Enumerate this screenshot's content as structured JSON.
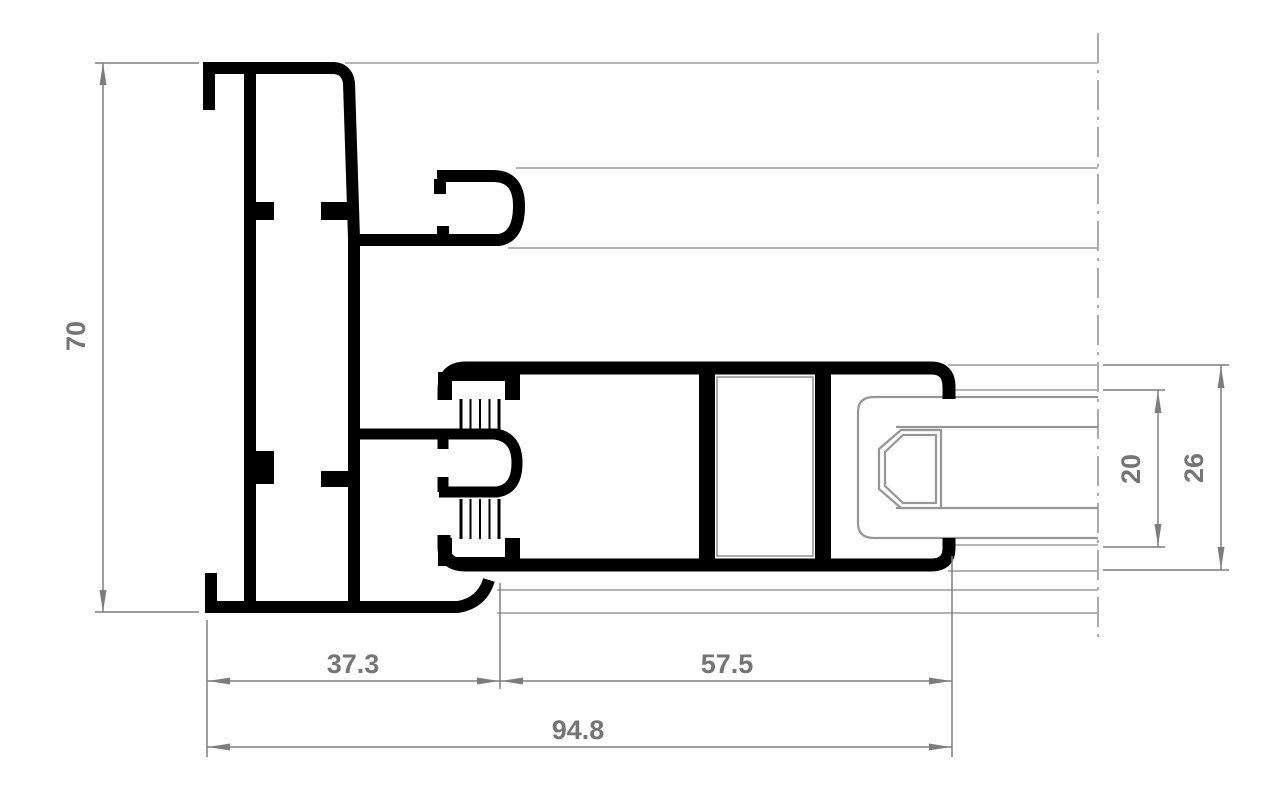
{
  "drawing": {
    "kind": "window-profile-cross-section",
    "background_color": "#ffffff",
    "profile_line_color": "#000000",
    "dimension_line_color": "#7d7d7d",
    "dimension_text_color": "#757575",
    "reference_line_color": "#b4b4b4"
  },
  "dimensions": {
    "frame_height": "70",
    "frame_depth": "37.3",
    "sash_extension": "57.5",
    "overall_depth": "94.8",
    "glazing_thickness": "20",
    "glazing_rebate": "26"
  }
}
